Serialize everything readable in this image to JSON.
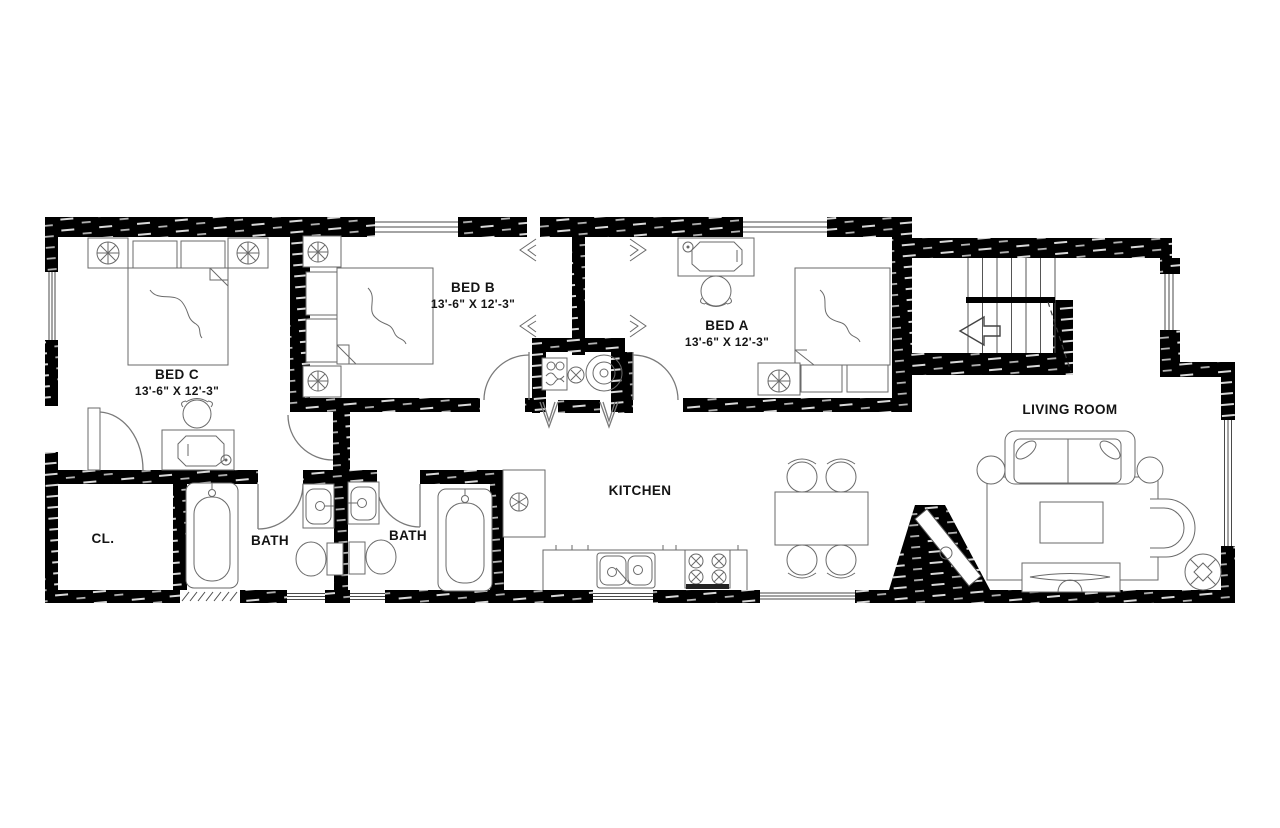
{
  "palette": {
    "background": "#ffffff",
    "wall": "#000000",
    "fixture_line": "#6a6a6a",
    "label": "#141414"
  },
  "rooms": {
    "bed_a": {
      "label": "BED A",
      "dims": "13'-6\" X 12'-3\""
    },
    "bed_b": {
      "label": "BED B",
      "dims": "13'-6\" X 12'-3\""
    },
    "bed_c": {
      "label": "BED C",
      "dims": "13'-6\" X 12'-3\""
    },
    "living_room": {
      "label": "LIVING ROOM"
    },
    "kitchen": {
      "label": "KITCHEN"
    },
    "bath_1": {
      "label": "BATH"
    },
    "bath_2": {
      "label": "BATH"
    },
    "closet": {
      "label": "CL."
    }
  }
}
